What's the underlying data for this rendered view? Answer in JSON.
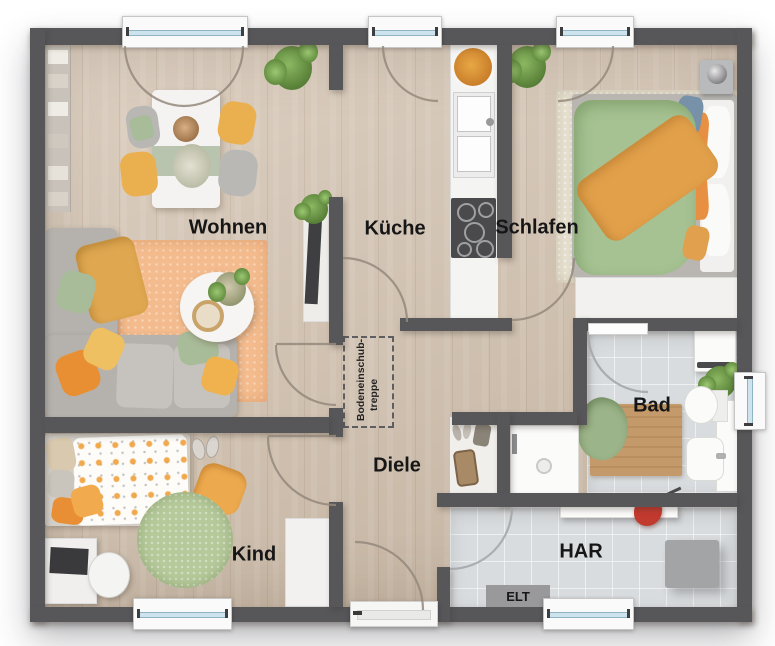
{
  "rooms": {
    "wohnen": "Wohnen",
    "kueche": "Küche",
    "schlafen": "Schlafen",
    "bad": "Bad",
    "diele": "Diele",
    "kind": "Kind",
    "har": "HAR",
    "elt": "ELT"
  },
  "annotations": {
    "loft_stairs": {
      "line1": "Bodeneinschub-",
      "line2": "treppe"
    }
  },
  "colors": {
    "wall": "#57575a",
    "wood_floor": "#d4c4b2",
    "tile_floor": "#d9dcde",
    "window_glass": "#cde4ee",
    "accent_orange": "#e8923f",
    "accent_yellow": "#eab04f",
    "accent_green": "#a6c292",
    "rug_peach": "#f4bc8e",
    "red_item": "#c2392e"
  }
}
